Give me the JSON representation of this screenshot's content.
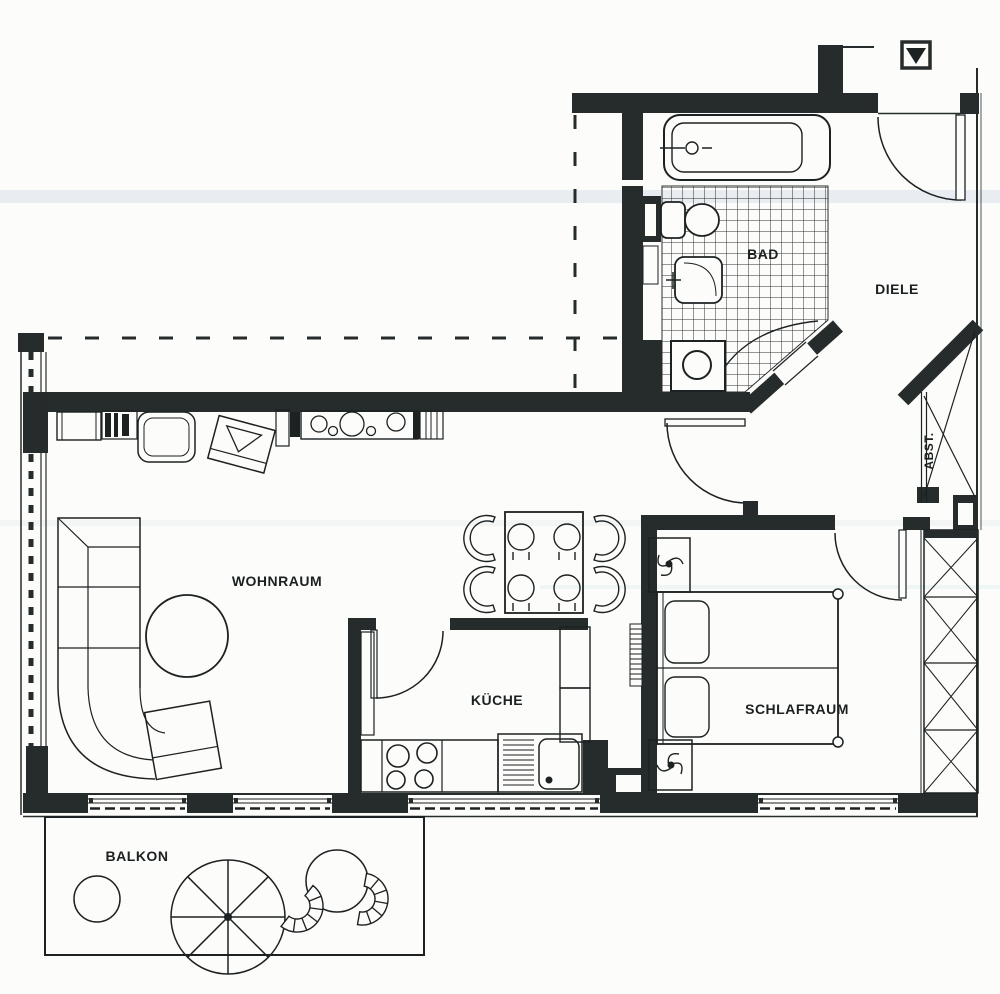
{
  "floorplan": {
    "kind": "scanned apartment floor plan (German)",
    "rooms": [
      {
        "id": "wohnraum",
        "label": "WOHNRAUM"
      },
      {
        "id": "kueche",
        "label": "KÜCHE"
      },
      {
        "id": "schlafraum",
        "label": "SCHLAFRAUM"
      },
      {
        "id": "bad",
        "label": "BAD"
      },
      {
        "id": "diele",
        "label": "DIELE"
      },
      {
        "id": "abstellraum",
        "label": "ABST."
      },
      {
        "id": "balkon",
        "label": "BALKON"
      }
    ],
    "symbols": {
      "entrance_marker": "filled triangle in square at top right",
      "window": "thin double lines with dashes",
      "wardrobe": "rectangles with X cross pattern",
      "bath_floor": "square tile grid"
    },
    "colors": {
      "wall": "#262b2b",
      "line": "#1c2121",
      "paper": "#fcfcfa",
      "scan_artifact": "#a8bcd2"
    }
  }
}
